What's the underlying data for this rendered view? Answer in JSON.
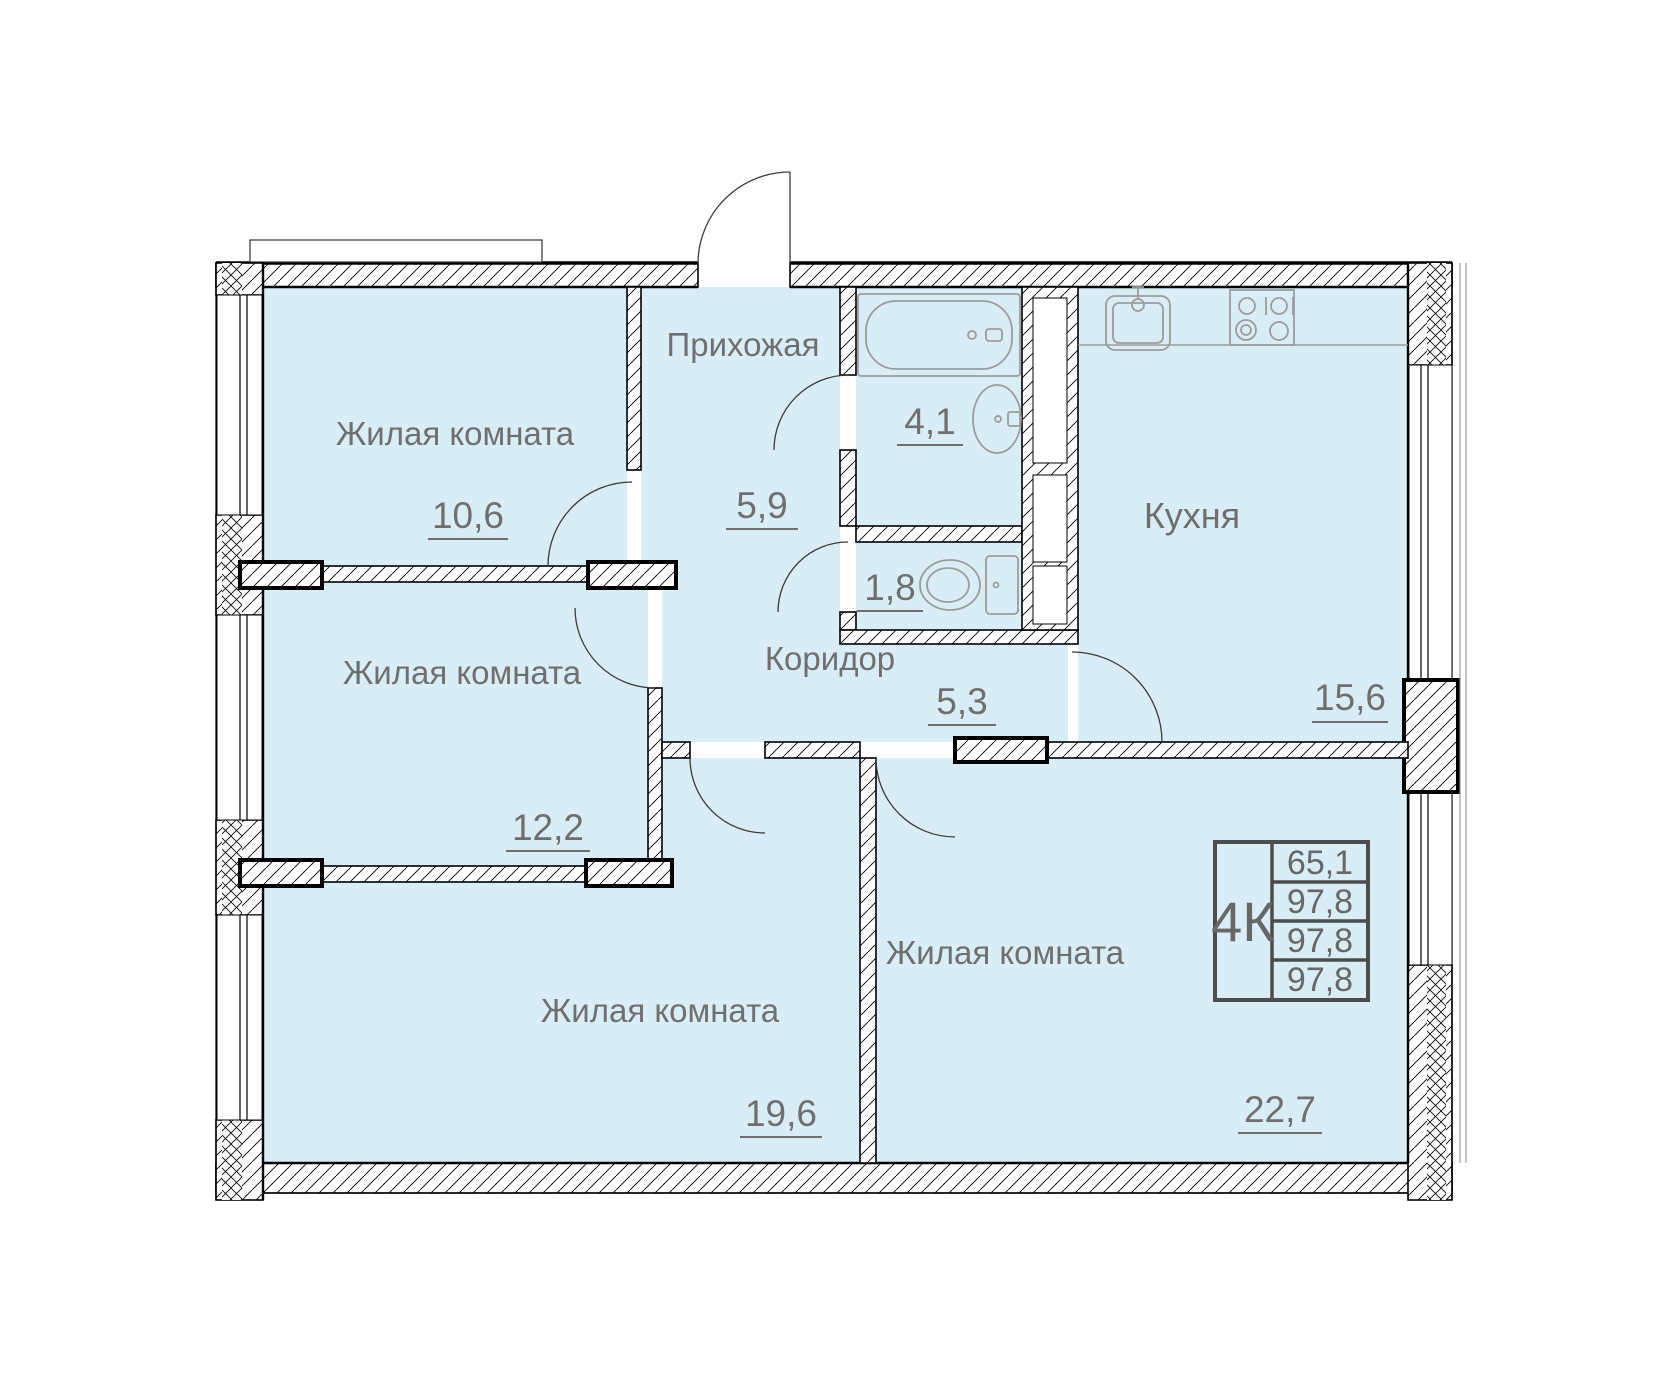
{
  "rooms": {
    "living_top": {
      "label": "Жилая комната",
      "area": "10,6"
    },
    "hallway": {
      "label": "Прихожая",
      "area": "5,9"
    },
    "bathroom": {
      "area": "4,1"
    },
    "wc": {
      "area": "1,8"
    },
    "kitchen": {
      "label": "Кухня",
      "area": "15,6"
    },
    "living_mid": {
      "label": "Жилая комната",
      "area": "12,2"
    },
    "corridor": {
      "label": "Коридор",
      "area": "5,3"
    },
    "living_bottom_left": {
      "label": "Жилая комната",
      "area": "19,6"
    },
    "living_bottom_right": {
      "label": "Жилая комната",
      "area": "22,7"
    }
  },
  "info_box": {
    "type_label": "4К",
    "rows": [
      "65,1",
      "97,8",
      "97,8",
      "97,8"
    ]
  },
  "colors": {
    "room_fill": "#d9edf7",
    "wall_line": "#000000",
    "label_text": "#6f6f6f",
    "fixture_line": "#9c9c9c",
    "table_border": "#4c4c4c"
  }
}
